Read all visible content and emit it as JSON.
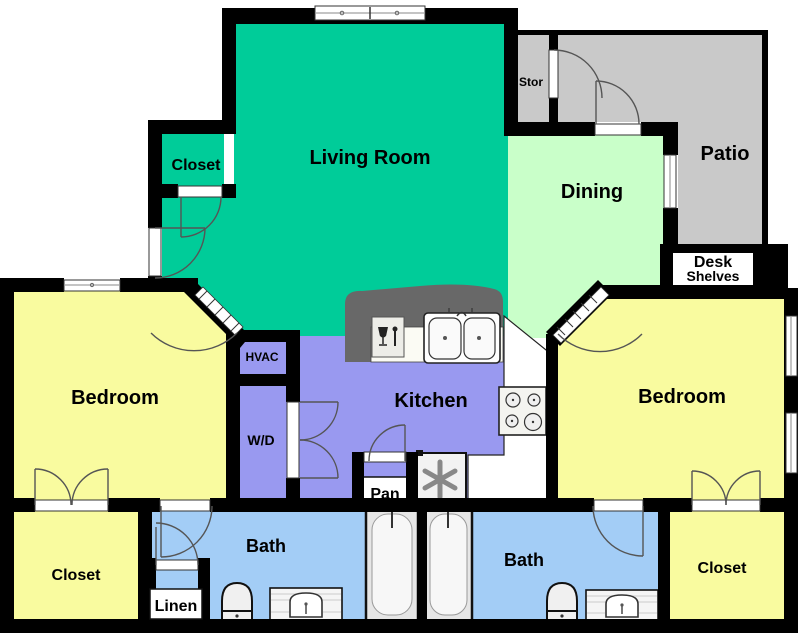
{
  "rooms": {
    "living_room": {
      "label": "Living Room"
    },
    "dining": {
      "label": "Dining"
    },
    "patio": {
      "label": "Patio"
    },
    "stor": {
      "label": "Stor"
    },
    "closet_top_left": {
      "label": "Closet"
    },
    "bedroom_left": {
      "label": "Bedroom"
    },
    "bedroom_right": {
      "label": "Bedroom"
    },
    "kitchen": {
      "label": "Kitchen"
    },
    "hvac": {
      "label": "HVAC"
    },
    "wd": {
      "label": "W/D"
    },
    "pan": {
      "label": "Pan"
    },
    "bath_left": {
      "label": "Bath"
    },
    "bath_right": {
      "label": "Bath"
    },
    "linen": {
      "label": "Linen"
    },
    "closet_bottom_left": {
      "label": "Closet"
    },
    "closet_bottom_right": {
      "label": "Closet"
    },
    "desk_nook": {
      "line1": "Desk",
      "line2": "Shelves"
    }
  },
  "colors": {
    "wall": "#000000",
    "living": "#00CC99",
    "dining": "#C9FFC9",
    "patio": "#C9C9C9",
    "yellow": "#F9FB9F",
    "purple": "#9999F0",
    "bath": "#A3CDF6",
    "counter_dark": "#686868",
    "counter_light": "#FFFFFF",
    "fixture": "#F2F2F2",
    "arc": "#555555"
  }
}
